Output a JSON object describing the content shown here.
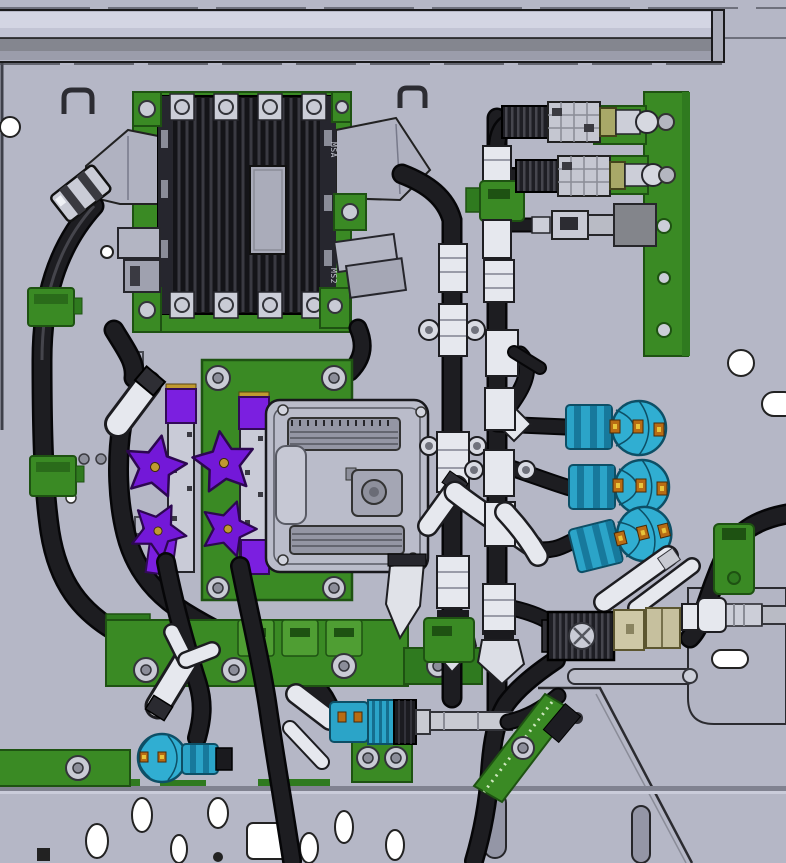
{
  "scene": {
    "description": "3D CAD rendering of a chassis-mounted electrical and coolant plumbing assembly"
  },
  "labels": {
    "module_marking_top": "MSA",
    "module_marking_bottom": "MS2"
  },
  "palette": {
    "panel": "#b5b7c6",
    "beam_gray": "#c2c4d4",
    "bracket_green": "#3a8a24",
    "hose_black": "#1d1d21",
    "fitting_white": "#e6e8ee",
    "fitting_silver": "#ccced8",
    "clamp_purple": "#7b1fe0",
    "coupler_cyan": "#2ba4c8",
    "clip_orange": "#b86c14"
  },
  "components": [
    {
      "id": "top-rail",
      "name": "Top frame rail"
    },
    {
      "id": "mounting-panel",
      "name": "Chassis mounting panel with holes"
    },
    {
      "id": "heatsink-module",
      "name": "Finned power module heat sink"
    },
    {
      "id": "left-hose-loop",
      "name": "Left coolant hose loop with clamps"
    },
    {
      "id": "ecu",
      "name": "Engine control unit on green plate"
    },
    {
      "id": "purple-clamps",
      "name": "Purple star hand clamps on slide rails"
    },
    {
      "id": "lower-rail",
      "name": "Lower green mounting rail"
    },
    {
      "id": "hoses",
      "name": "Black coolant hoses"
    },
    {
      "id": "coolant-manifold",
      "name": "Center manifold pipe runs with white fittings"
    },
    {
      "id": "connector-bracket",
      "name": "Green connector bracket with inline connectors"
    },
    {
      "id": "cyan-couplers",
      "name": "Cyan quick-connect couplers"
    },
    {
      "id": "lower-right-connectors",
      "name": "Lower right connector row and green strap"
    }
  ]
}
